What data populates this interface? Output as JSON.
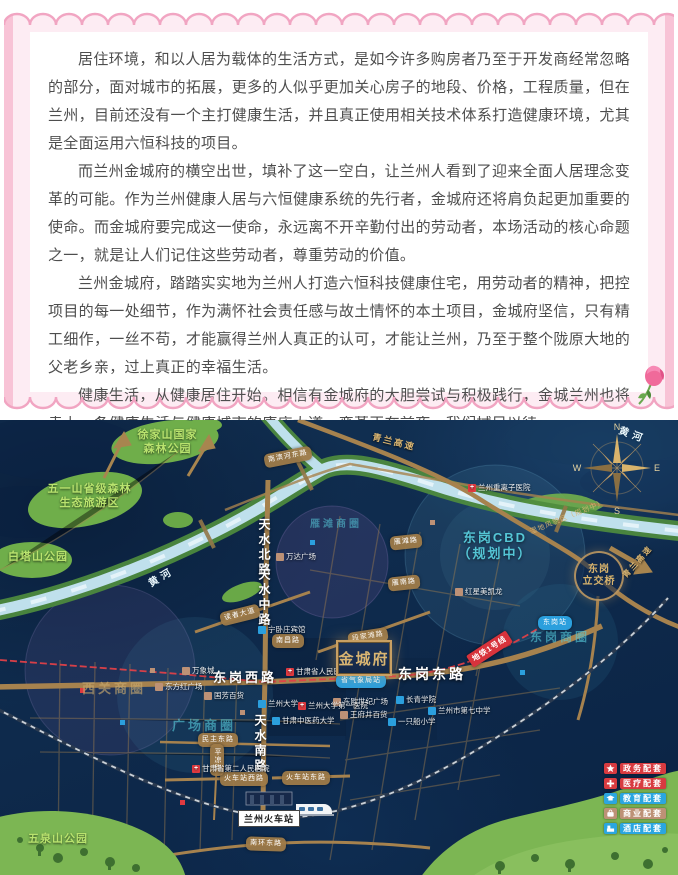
{
  "article": {
    "paragraphs": [
      "居住环境，和以人居为载体的生活方式，是如今许多购房者乃至于开发商经常忽略的部分，面对城市的拓展，更多的人似乎更加关心房子的地段、价格，工程质量，但在兰州，目前还没有一个主打健康生活，并且真正使用相关技术体系打造健康环境，尤其是全面运用六恒科技的项目。",
      "而兰州金城府的横空出世，填补了这一空白，让兰州人看到了迎来全面人居理念变革的可能。作为兰州健康人居与六恒健康系统的先行者，金城府还将肩负起更加重要的使命。而金城府要完成这一使命，永远离不开辛勤付出的劳动者，本场活动的核心命题之一，就是让人们记住这些劳动者，尊重劳动的价值。",
      "兰州金城府，踏踏实实地为兰州人打造六恒科技健康住宅，用劳动者的精神，把控项目的每一处细节，作为满怀社会责任感与故土情怀的本土项目，金城府坚信，只有精工细作，一丝不苟，才能赢得兰州人真正的认可，才能让兰州，乃至于整个陇原大地的父老乡亲，过上真正的幸福生活。",
      "健康生活，从健康居住开始。相信有金城府的大胆尝试与积极践行，金城兰州也将走上一条健康生活与健康城市的康庄大道。变革正在前夜，我们拭目以待。"
    ]
  },
  "map": {
    "parks": [
      "徐家山国家\n森林公园",
      "五一山省级森林\n生态旅游区",
      "白塔山公园",
      "五泉山公园"
    ],
    "river_labels": [
      "黄河",
      "黄河"
    ],
    "roads_big": [
      "东岗西路",
      "东岗东路"
    ],
    "roads_vertical": [
      "天水北路",
      "天水中路",
      "天水南路"
    ],
    "road_pills": [
      "段家滩路",
      "读者大道",
      "南昌路",
      "雁南路",
      "雁滩路",
      "南滨河东路",
      "民主东路",
      "火车站西路",
      "火车站东路",
      "南环东路",
      "平凉路"
    ],
    "areas": [
      "西关商圈",
      "广场商圈",
      "东岗商圈",
      "雁滩商圈"
    ],
    "cbd": "东岗CBD\n（规划中）",
    "interchange": "东岗\n立交桥",
    "highways": [
      "青兰高速",
      "青兰高速"
    ],
    "wetland": "湿地风貌区（规划中）",
    "metro_badge": "地铁1号线",
    "metro_stations": [
      "省气象局站",
      "东岗站"
    ],
    "pois": [
      {
        "name": "万象城",
        "type": "commercial"
      },
      {
        "name": "东方红广场",
        "type": "commercial"
      },
      {
        "name": "国芳百货",
        "type": "commercial"
      },
      {
        "name": "万达广场",
        "type": "commercial"
      },
      {
        "name": "红星美凯龙",
        "type": "commercial"
      },
      {
        "name": "东欧世纪广场",
        "type": "commercial"
      },
      {
        "name": "王府井百货",
        "type": "commercial"
      },
      {
        "name": "甘肃省人民医院",
        "type": "medical"
      },
      {
        "name": "兰州大学第一医院",
        "type": "medical"
      },
      {
        "name": "兰州重离子医院",
        "type": "medical"
      },
      {
        "name": "甘肃省第二人民医院",
        "type": "medical"
      },
      {
        "name": "兰州大学",
        "type": "education"
      },
      {
        "name": "甘肃中医药大学",
        "type": "education"
      },
      {
        "name": "兰州市第七中学",
        "type": "education"
      },
      {
        "name": "一只船小学",
        "type": "education"
      },
      {
        "name": "长青学院",
        "type": "education"
      },
      {
        "name": "宁卧庄宾馆",
        "type": "hotel"
      }
    ],
    "station_name": "兰州火车站",
    "project_name": "金城府",
    "compass": {
      "n": "N",
      "e": "E",
      "s": "S",
      "w": "W"
    },
    "legend": [
      {
        "label": "政务配套",
        "color": "#d83b40"
      },
      {
        "label": "医疗配套",
        "color": "#d83b40"
      },
      {
        "label": "教育配套",
        "color": "#2ba6e0"
      },
      {
        "label": "商业配套",
        "color": "#bd9176"
      },
      {
        "label": "酒店配套",
        "color": "#2ba6e0"
      }
    ]
  }
}
